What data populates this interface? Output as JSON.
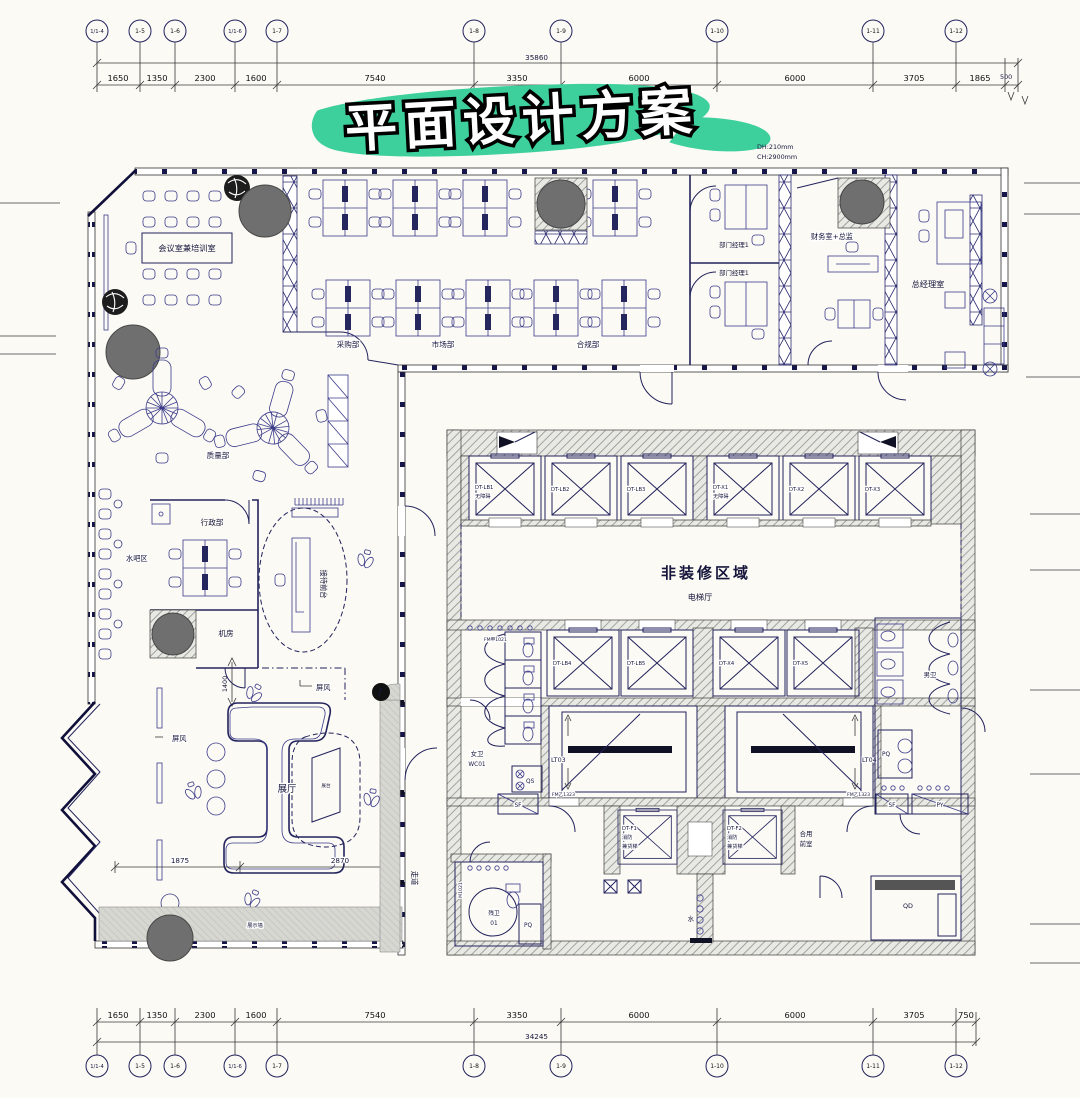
{
  "title": {
    "text": "平面设计方案"
  },
  "colors": {
    "accent": "#3dcf9c",
    "column_gray": "#6f6f6f",
    "wall_blue": "#22225c"
  },
  "notes": {
    "dh": "DH:210mm",
    "ch": "CH:2900mm"
  },
  "grid_top": {
    "bubbles": [
      "1/1-4",
      "1-5",
      "1-6",
      "1/1-6",
      "1-7",
      "1-8",
      "1-9",
      "1-10",
      "1-11",
      "1-12"
    ],
    "dims": [
      "1650",
      "1350",
      "2300",
      "1600",
      "7540",
      "3350",
      "6000",
      "6000",
      "3705",
      "1865"
    ],
    "edge": "500",
    "overall": "35860"
  },
  "grid_bottom": {
    "bubbles": [
      "1/1-4",
      "1-5",
      "1-6",
      "1/1-6",
      "1-7",
      "1-8",
      "1-9",
      "1-10",
      "1-11",
      "1-12"
    ],
    "dims": [
      "1650",
      "1350",
      "2300",
      "1600",
      "7540",
      "3350",
      "6000",
      "6000",
      "3705",
      "750"
    ],
    "overall": "34245"
  },
  "rooms": {
    "meeting": "会议室兼培训室",
    "purchasing": "采购部",
    "marketing": "市场部",
    "compliance": "合规部",
    "manager1": "部门经理1",
    "manager2": "部门经理1",
    "finance": "财务室+总监",
    "general_manager": "总经理室",
    "quality": "质量部",
    "admin": "行政部",
    "water_bar": "水吧区",
    "server_room": "机房",
    "reception": "接待前台",
    "screen_a": "屏风",
    "screen_b": "屏风",
    "exhibition": "展厅",
    "display_stand": "展台",
    "display_wall": "展示墙",
    "corridor": "走道",
    "non_renovation": "非装修区域",
    "elevator_hall": "电梯厅",
    "female_wc": "女卫",
    "female_wc_code": "WC01",
    "male_wc": "男卫",
    "accessible_wc": "残卫",
    "accessible_wc_code": "01",
    "shared_vestibule_line1": "合用",
    "shared_vestibule_line2": "前室",
    "water": "水",
    "qs": "QS",
    "sf1": "SF",
    "sf2": "SF",
    "py": "PY",
    "pq1": "PQ",
    "pq2": "PQ",
    "qd": "QD"
  },
  "stairs": {
    "lt03": "LT03",
    "lt04": "LT04"
  },
  "elevators": {
    "r1c1": "DT-LB1",
    "r1c1_note": "无障碍",
    "r1c2": "DT-LB2",
    "r1c3": "DT-LB3",
    "r1c4": "DT-X1",
    "r1c4_note": "无障碍",
    "r1c5": "DT-X2",
    "r1c6": "DT-X3",
    "r2c1": "DT-LB4",
    "r2c2": "DT-LB5",
    "r2c3": "DT-X4",
    "r2c4": "DT-X5",
    "f1": "DT-F1",
    "f1_note1": "消防",
    "f1_note2": "兼货梯",
    "f2": "DT-F2",
    "f2_note1": "消防",
    "f2_note2": "兼货梯"
  },
  "door_tags": {
    "t1": "FM甲1021",
    "t2": "FM乙1323",
    "t3": "FM乙1323",
    "t4": "M1021"
  },
  "inner_dims": {
    "d1400": "1400",
    "d1875": "1875",
    "d2870": "2870"
  },
  "icons": {
    "corridor_marker": "f"
  }
}
